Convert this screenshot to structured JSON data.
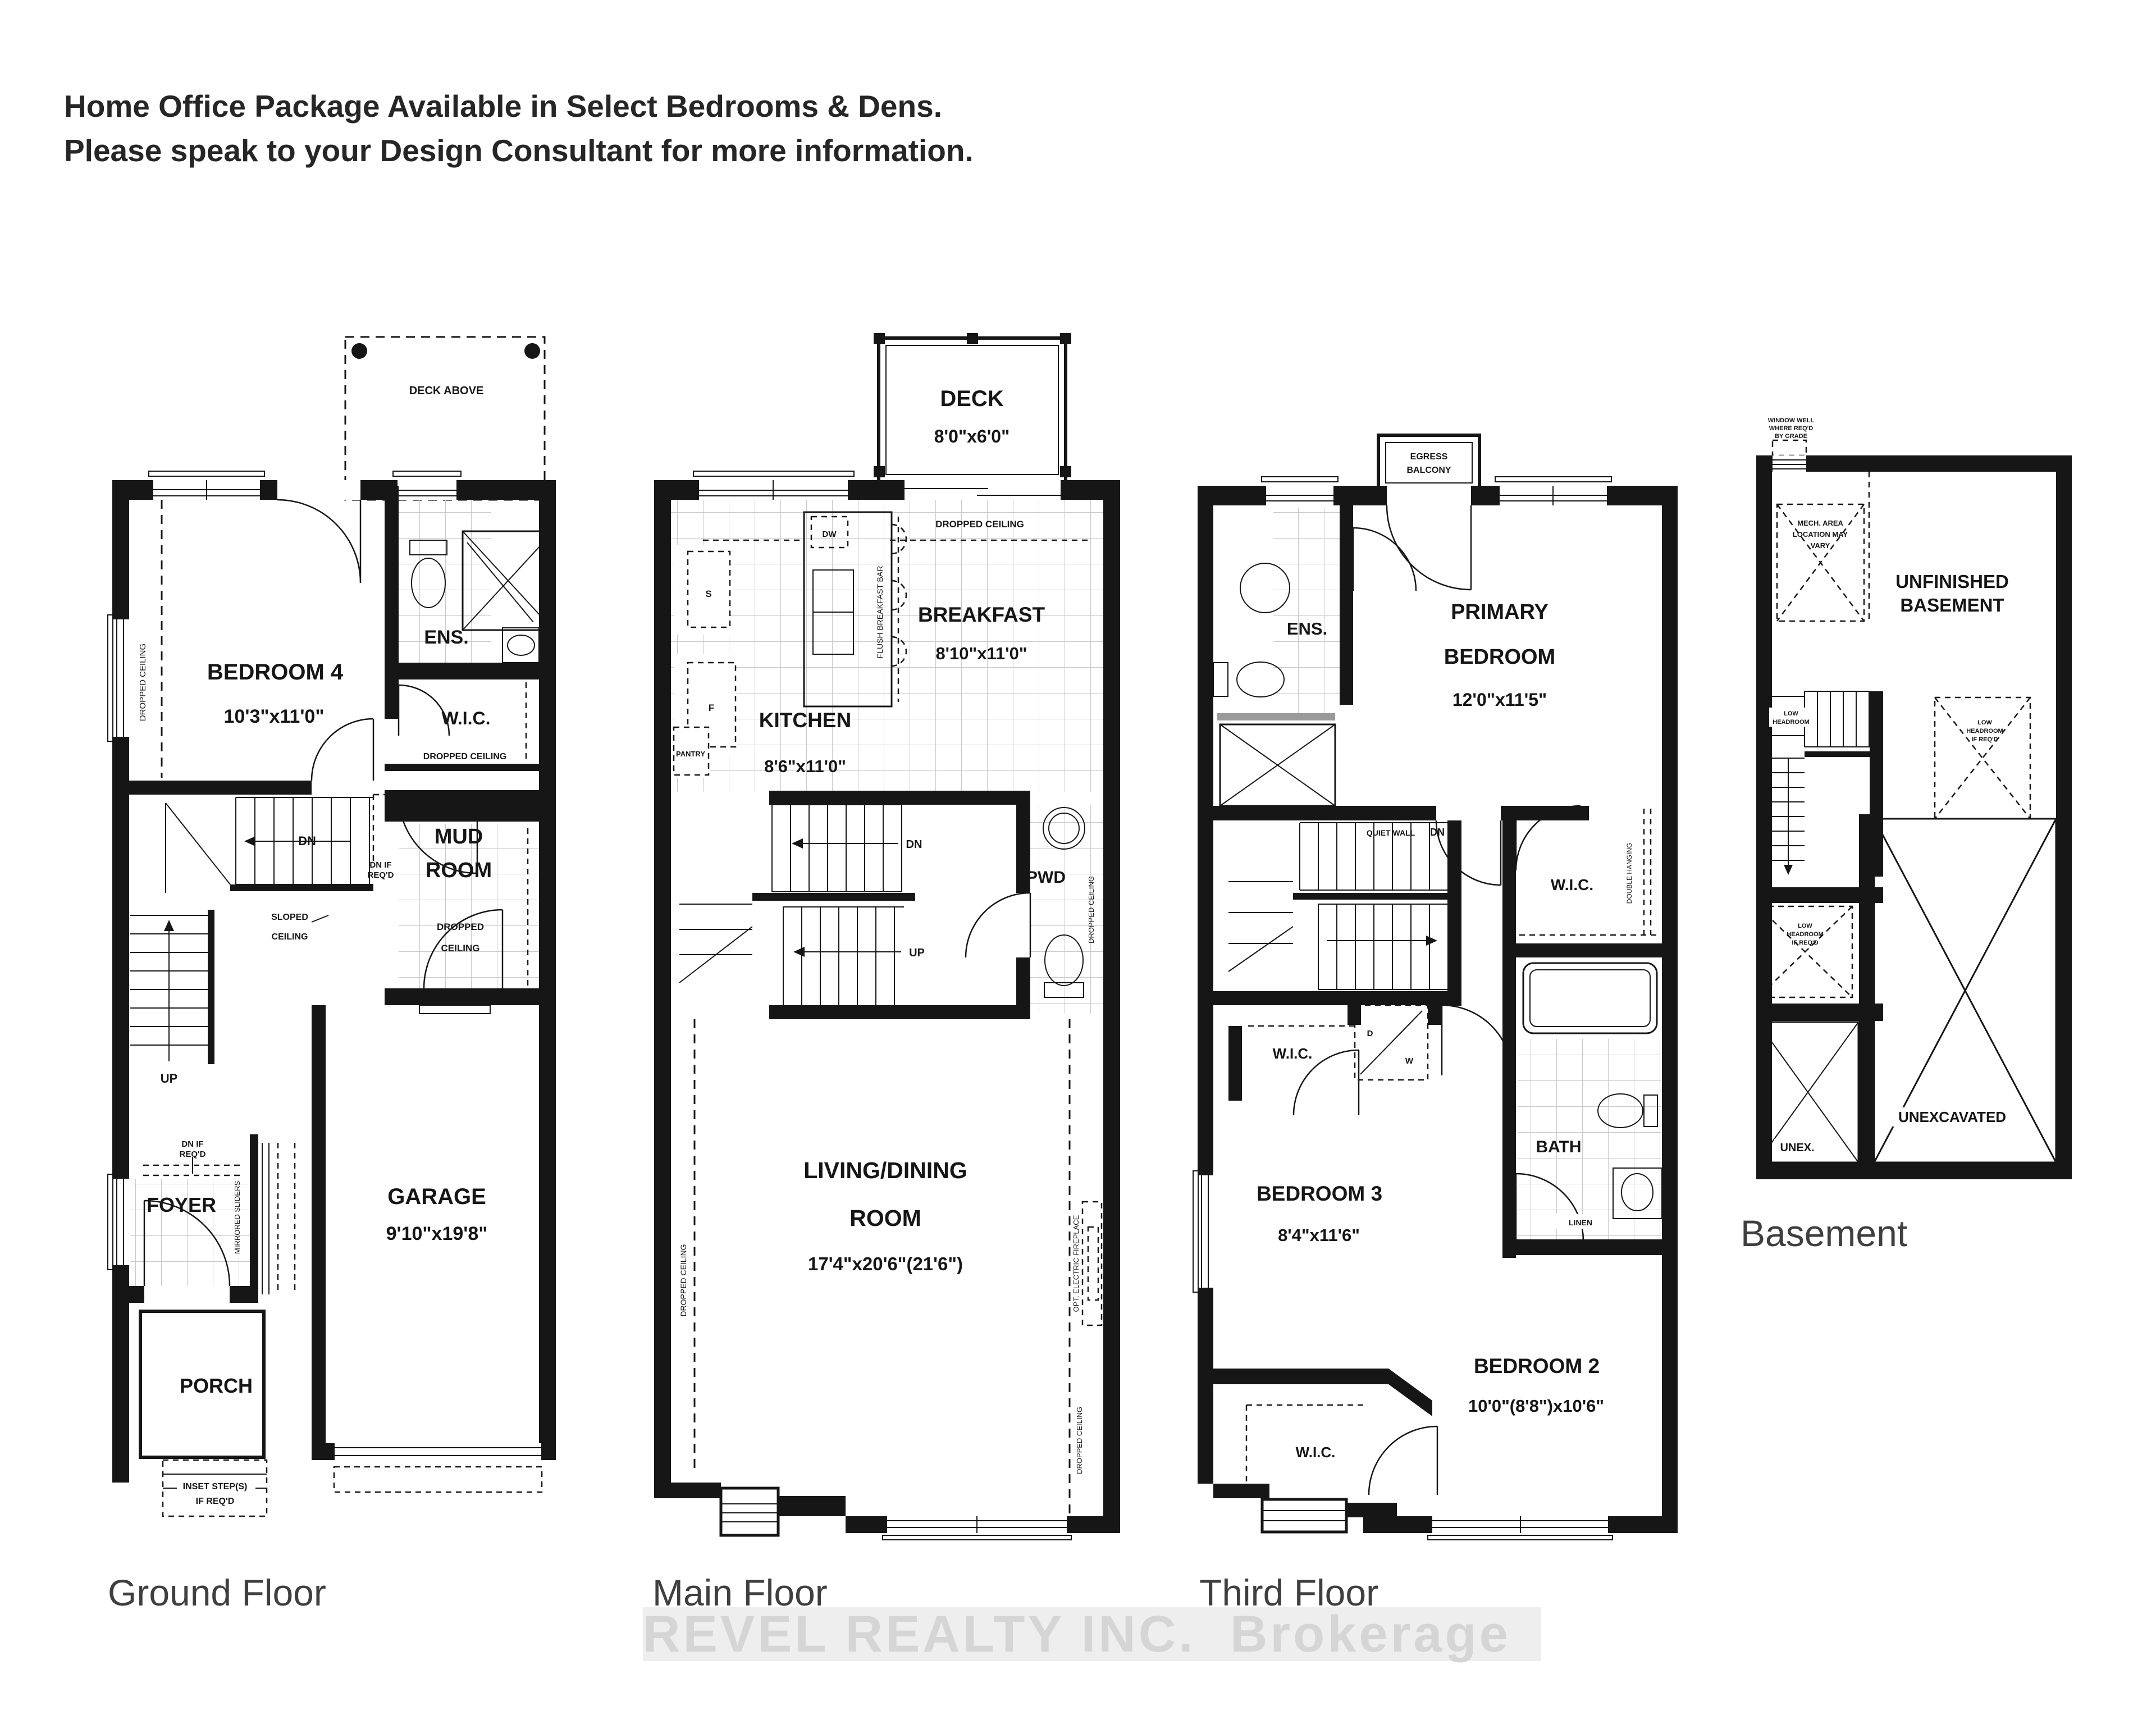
{
  "header": {
    "line1": "Home Office Package Available in Select Bedrooms & Dens.",
    "line2": "Please speak to your Design Consultant for more information."
  },
  "watermark": {
    "text": "REVEL REALTY INC.  Brokerage"
  },
  "colors": {
    "wall": "#161616",
    "grid": "#c9c9c9",
    "title": "#3f3f3f",
    "watermark_text": "#d5d5d5",
    "watermark_band": "#eeeeee"
  },
  "ground": {
    "title": "Ground Floor",
    "deck_above": "DECK ABOVE",
    "bedroom4": "BEDROOM 4",
    "bedroom4_dims": "10'3\"x11'0\"",
    "ens": "ENS.",
    "wic": "W.I.C.",
    "wic_note": "DROPPED CEILING",
    "dc_left": "DROPPED CEILING",
    "mud1": "MUD",
    "mud2": "ROOM",
    "mud_note1": "DROPPED",
    "mud_note2": "CEILING",
    "dn": "DN",
    "up": "UP",
    "dnif1": "DN IF",
    "dnif2": "REQ'D",
    "dnif3": "DN IF",
    "dnif4": "REQ'D",
    "sloped1": "SLOPED",
    "sloped2": "CEILING",
    "foyer": "FOYER",
    "sliders": "MIRRORED SLIDERS",
    "garage": "GARAGE",
    "garage_dims": "9'10\"x19'8\"",
    "porch": "PORCH",
    "inset1": "INSET STEP(S)",
    "inset2": "IF REQ'D"
  },
  "main": {
    "title": "Main Floor",
    "deck": "DECK",
    "deck_dims": "8'0\"x6'0\"",
    "dc_top": "DROPPED CEILING",
    "breakfast": "BREAKFAST",
    "breakfast_dims": "8'10\"x11'0\"",
    "kitchen": "KITCHEN",
    "kitchen_dims": "8'6\"x11'0\"",
    "dw": "DW",
    "bar": "FLUSH BREAKFAST BAR",
    "s": "S",
    "f": "F",
    "pantry": "PANTRY",
    "dn": "DN",
    "up": "UP",
    "pwd": "PWD",
    "pwd_dc": "DROPPED CEILING",
    "living1": "LIVING/DINING",
    "living2": "ROOM",
    "living_dims": "17'4\"x20'6\"(21'6\")",
    "dc_left": "DROPPED CEILING",
    "fireplace": "OPT. ELECTRIC FIREPLACE",
    "dc_right": "DROPPED CEILING"
  },
  "third": {
    "title": "Third Floor",
    "egress1": "EGRESS",
    "egress2": "BALCONY",
    "ens": "ENS.",
    "primary1": "PRIMARY",
    "primary2": "BEDROOM",
    "primary_dims": "12'0\"x11'5\"",
    "quiet": "QUIET WALL",
    "dn": "DN",
    "wic_primary": "W.I.C.",
    "double_hanging": "DOUBLE HANGING",
    "d": "D",
    "w": "W",
    "wic_bed3": "W.I.C.",
    "bath": "BATH",
    "linen": "LINEN",
    "bedroom3": "BEDROOM 3",
    "bedroom3_dims": "8'4\"x11'6\"",
    "bedroom2": "BEDROOM 2",
    "bedroom2_dims": "10'0\"(8'8\")x10'6\"",
    "wic_bed2": "W.I.C."
  },
  "basement": {
    "title": "Basement",
    "ww1": "WINDOW WELL",
    "ww2": "WHERE REQ'D",
    "ww3": "BY GRADE",
    "mech1": "MECH. AREA",
    "mech2": "LOCATION MAY",
    "mech3": "VARY",
    "unf1": "UNFINISHED",
    "unf2": "BASEMENT",
    "lh1": "LOW",
    "lh2": "HEADROOM",
    "lhr1": "LOW",
    "lhr2": "HEADROOM",
    "lhr3": "IF REQ'D",
    "lhl1": "LOW",
    "lhl2": "HEADROOM",
    "lhl3": "IF REQ'D",
    "unex": "UNEX.",
    "unexcavated": "UNEXCAVATED"
  }
}
